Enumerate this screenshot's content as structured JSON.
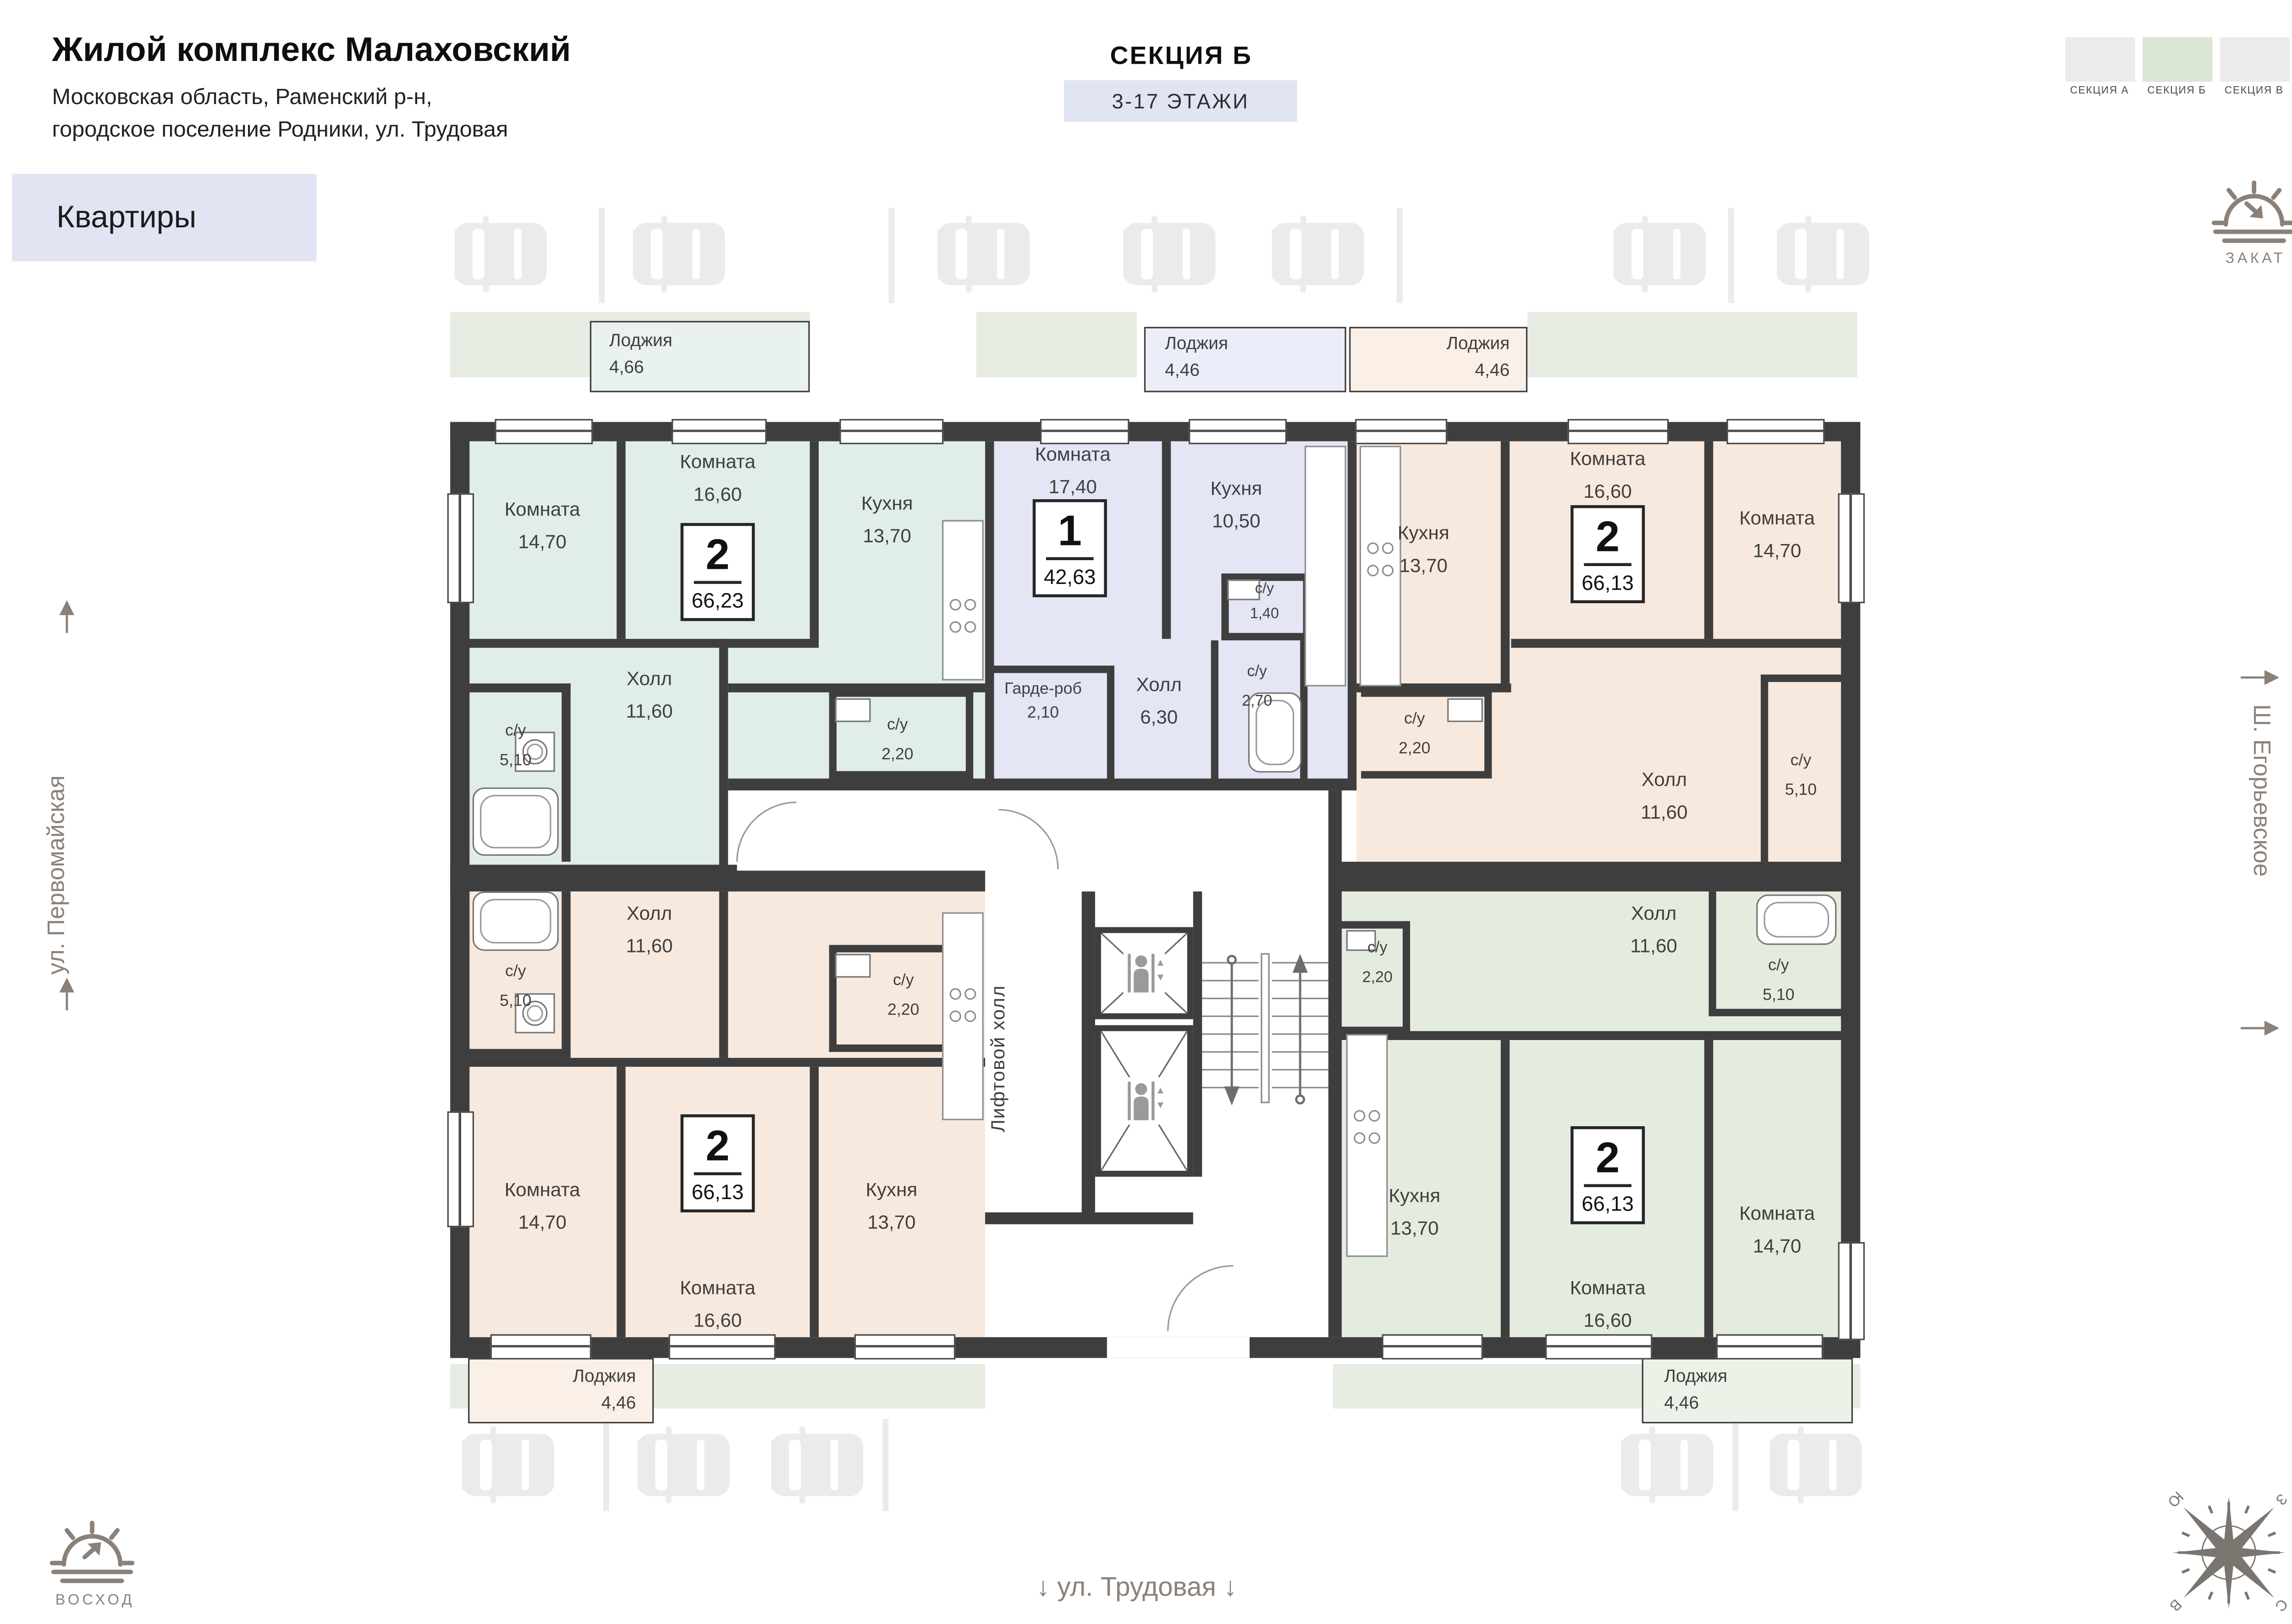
{
  "header": {
    "title": "Жилой комплекс Малаховский",
    "subtitle_line1": "Московская область, Раменский р-н,",
    "subtitle_line2": "городское поселение Родники, ул. Трудовая",
    "section_label": "СЕКЦИЯ Б",
    "floors_label": "3-17 ЭТАЖИ",
    "apartments_button": "Квартиры"
  },
  "legend": {
    "items": [
      {
        "label": "СЕКЦИЯ А",
        "color": "#EBEBEB",
        "active": false
      },
      {
        "label": "СЕКЦИЯ Б",
        "color": "#DBE7D4",
        "active": true
      },
      {
        "label": "СЕКЦИЯ В",
        "color": "#EBEBEB",
        "active": false
      }
    ]
  },
  "orientation": {
    "sunset_label": "ЗАКАТ",
    "sunrise_label": "ВОСХОД",
    "compass": {
      "north": "С",
      "south": "Ю",
      "west": "З",
      "east": "В"
    }
  },
  "streets": {
    "left": "ул. Первомайская",
    "right": "Ш. Егорьевское",
    "bottom": "ул. Трудовая",
    "arrow_down": "↓"
  },
  "core": {
    "lift_hall_label": "Лифтовой холл"
  },
  "colors": {
    "wall": "#3E3E3E",
    "ui_accent": "#E1E4F3",
    "greenery": "#E6ECE2",
    "parking_icon": "#EBEBEB",
    "label_text": "#3F3F3F",
    "street_text": "#8B8178"
  },
  "apartments": [
    {
      "type": "2",
      "area": "66,23",
      "color": "#E0EDEA",
      "rooms": [
        {
          "name": "Лоджия",
          "area": "4,66"
        },
        {
          "name": "Комната",
          "area": "14,70"
        },
        {
          "name": "Комната",
          "area": "16,60"
        },
        {
          "name": "Кухня",
          "area": "13,70"
        },
        {
          "name": "с/у",
          "area": "2,20"
        },
        {
          "name": "с/у",
          "area": "5,10"
        },
        {
          "name": "Холл",
          "area": "11,60"
        }
      ]
    },
    {
      "type": "1",
      "area": "42,63",
      "color": "#E4E6F6",
      "rooms": [
        {
          "name": "Лоджия",
          "area": "4,46"
        },
        {
          "name": "Комната",
          "area": "17,40"
        },
        {
          "name": "Кухня",
          "area": "10,50"
        },
        {
          "name": "с/у",
          "area": "1,40"
        },
        {
          "name": "с/у",
          "area": "2,70"
        },
        {
          "name": "Холл",
          "area": "6,30"
        },
        {
          "name": "Гарде-роб",
          "area": "2,10"
        }
      ]
    },
    {
      "type": "2",
      "area": "66,13",
      "color": "#F8E9DE",
      "rooms": [
        {
          "name": "Лоджия",
          "area": "4,46"
        },
        {
          "name": "Кухня",
          "area": "13,70"
        },
        {
          "name": "Комната",
          "area": "16,60"
        },
        {
          "name": "Комната",
          "area": "14,70"
        },
        {
          "name": "с/у",
          "area": "2,20"
        },
        {
          "name": "Холл",
          "area": "11,60"
        },
        {
          "name": "с/у",
          "area": "5,10"
        }
      ]
    },
    {
      "type": "2",
      "area": "66,13",
      "color": "#F8E9DE",
      "rooms": [
        {
          "name": "с/у",
          "area": "5,10"
        },
        {
          "name": "Холл",
          "area": "11,60"
        },
        {
          "name": "с/у",
          "area": "2,20"
        },
        {
          "name": "Комната",
          "area": "14,70"
        },
        {
          "name": "Комната",
          "area": "16,60"
        },
        {
          "name": "Кухня",
          "area": "13,70"
        },
        {
          "name": "Лоджия",
          "area": "4,46"
        }
      ]
    },
    {
      "type": "2",
      "area": "66,13",
      "color": "#E4ECDF",
      "rooms": [
        {
          "name": "с/у",
          "area": "2,20"
        },
        {
          "name": "Холл",
          "area": "11,60"
        },
        {
          "name": "с/у",
          "area": "5,10"
        },
        {
          "name": "Кухня",
          "area": "13,70"
        },
        {
          "name": "Комната",
          "area": "16,60"
        },
        {
          "name": "Комната",
          "area": "14,70"
        },
        {
          "name": "Лоджия",
          "area": "4,46"
        }
      ]
    }
  ]
}
